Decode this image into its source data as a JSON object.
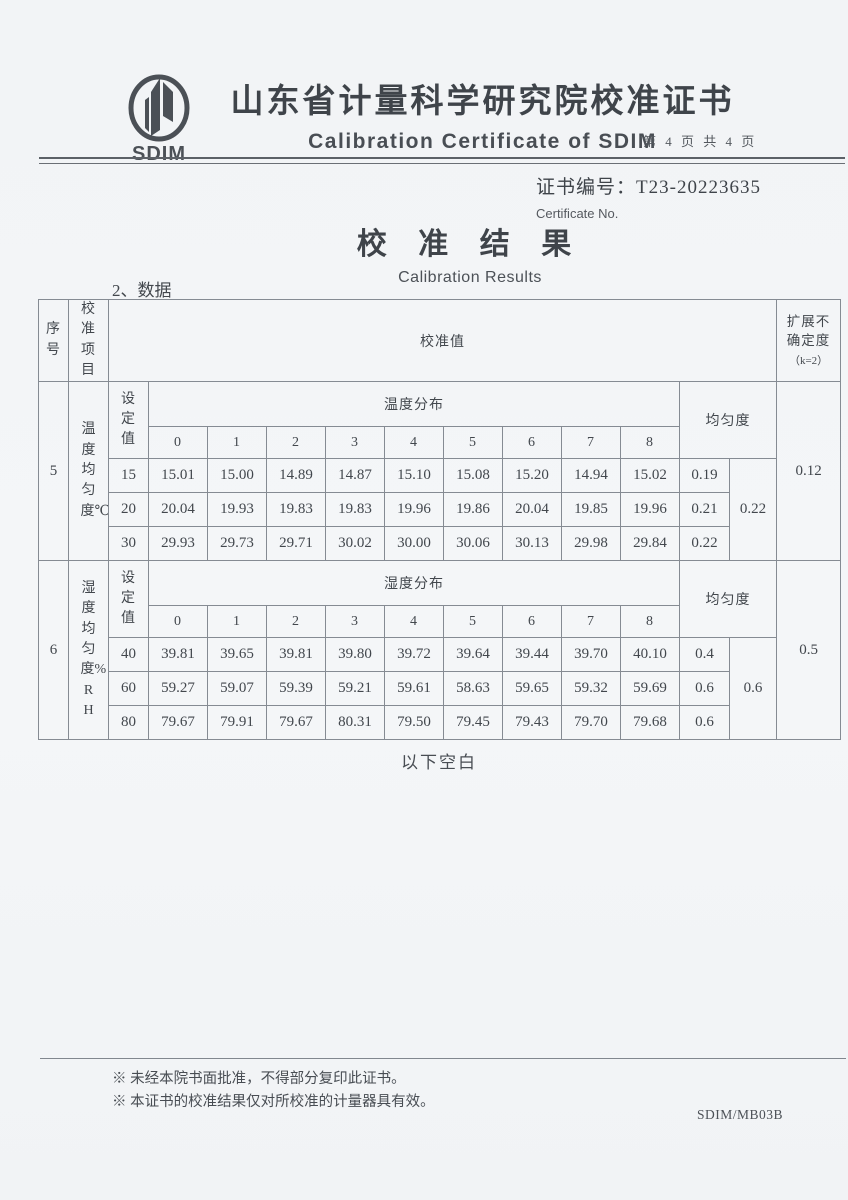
{
  "header": {
    "logo_text": "SDIM",
    "title_cn": "山东省计量科学研究院校准证书",
    "title_en": "Calibration Certificate of SDIM",
    "page_info": "第 4 页 共 4 页"
  },
  "certificate": {
    "no_label": "证书编号：",
    "no_value": "T23-20223635",
    "no_label_en": "Certificate No."
  },
  "section": {
    "title_cn": "校 准 结 果",
    "title_en": "Calibration Results",
    "data_label": "2、数据"
  },
  "table": {
    "headers": {
      "seq": "序号",
      "item": "校准项目",
      "value": "校准值",
      "uncertainty_line1": "扩展不确定度",
      "uncertainty_line2": "（k=2）",
      "set_value": "设定值",
      "uniformity": "均匀度",
      "dist_cols": [
        "0",
        "1",
        "2",
        "3",
        "4",
        "5",
        "6",
        "7",
        "8"
      ]
    },
    "blocks": [
      {
        "seq": "5",
        "item": "温度均匀度℃",
        "dist_label": "温度分布",
        "rows": [
          {
            "set": "15",
            "values": [
              "15.01",
              "15.00",
              "14.89",
              "14.87",
              "15.10",
              "15.08",
              "15.20",
              "14.94",
              "15.02"
            ],
            "uniformity": "0.19"
          },
          {
            "set": "20",
            "values": [
              "20.04",
              "19.93",
              "19.83",
              "19.83",
              "19.96",
              "19.86",
              "20.04",
              "19.85",
              "19.96"
            ],
            "uniformity": "0.21"
          },
          {
            "set": "30",
            "values": [
              "29.93",
              "29.73",
              "29.71",
              "30.02",
              "30.00",
              "30.06",
              "30.13",
              "29.98",
              "29.84"
            ],
            "uniformity": "0.22"
          }
        ],
        "overall_uniformity": "0.22",
        "uncertainty": "0.12"
      },
      {
        "seq": "6",
        "item": "湿度均匀度%RH",
        "dist_label": "湿度分布",
        "rows": [
          {
            "set": "40",
            "values": [
              "39.81",
              "39.65",
              "39.81",
              "39.80",
              "39.72",
              "39.64",
              "39.44",
              "39.70",
              "40.10"
            ],
            "uniformity": "0.4"
          },
          {
            "set": "60",
            "values": [
              "59.27",
              "59.07",
              "59.39",
              "59.21",
              "59.61",
              "58.63",
              "59.65",
              "59.32",
              "59.69"
            ],
            "uniformity": "0.6"
          },
          {
            "set": "80",
            "values": [
              "79.67",
              "79.91",
              "79.67",
              "80.31",
              "79.50",
              "79.45",
              "79.43",
              "79.70",
              "79.68"
            ],
            "uniformity": "0.6"
          }
        ],
        "overall_uniformity": "0.6",
        "uncertainty": "0.5"
      }
    ],
    "below_blank": "以下空白"
  },
  "footer": {
    "note1": "※ 未经本院书面批准，不得部分复印此证书。",
    "note2": "※ 本证书的校准结果仅对所校准的计量器具有效。",
    "form_no": "SDIM/MB03B"
  }
}
